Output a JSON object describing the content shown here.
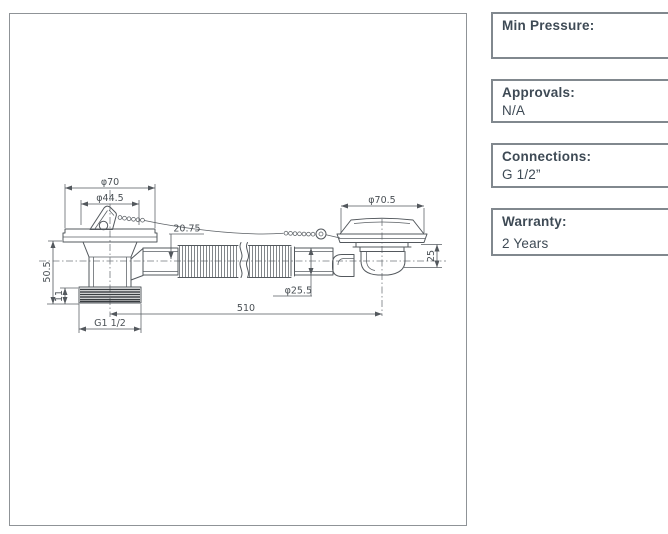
{
  "info_panel": {
    "boxes": [
      {
        "label": "Min Pressure:",
        "value": ""
      },
      {
        "label": "Approvals:",
        "value": "N/A"
      },
      {
        "label": "Connections:",
        "value": "G 1/2”"
      },
      {
        "label": "Warranty:",
        "value": "2 Years"
      }
    ]
  },
  "drawing": {
    "labels": {
      "dia_top_left": "φ70",
      "dia_top_left_inner": "φ44.5",
      "offset": "20.75",
      "dia_top_right": "φ70.5",
      "height_left": "50.5",
      "height_thread": "11",
      "height_right": "25",
      "dia_hose": "φ25.5",
      "length_overall": "510",
      "thread": "G1 1/2"
    }
  }
}
